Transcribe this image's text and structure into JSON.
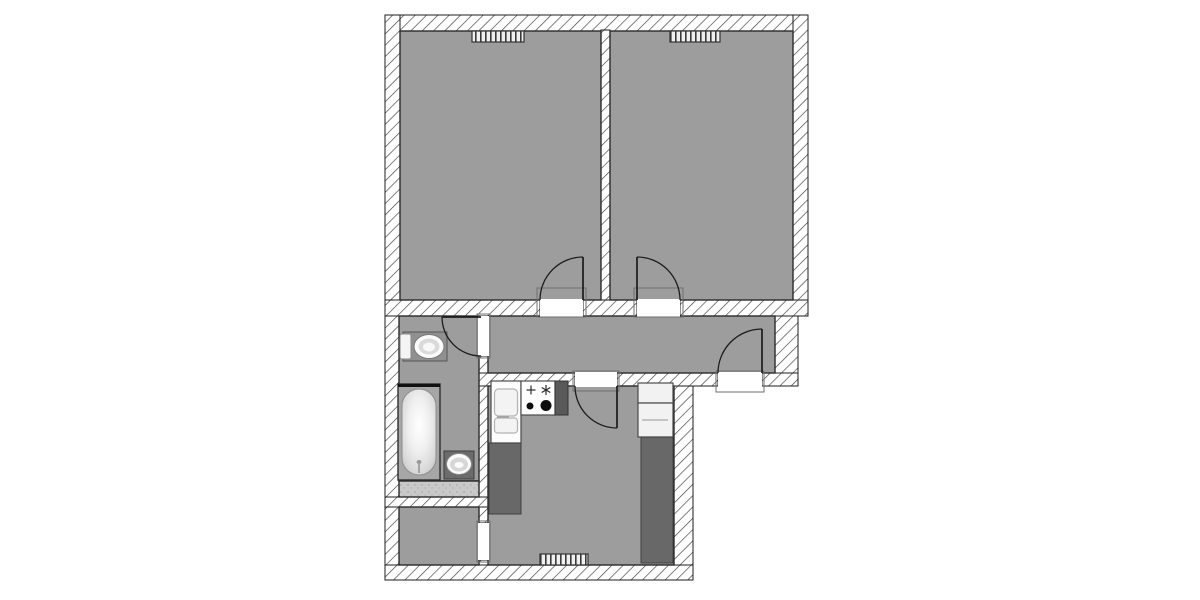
{
  "meta": {
    "type": "apartment-floor-plan",
    "canvas": {
      "width": 1200,
      "height": 600,
      "background": "#ffffff"
    }
  },
  "palette": {
    "floor": "#9d9d9d",
    "wall_outline": "#1d1d1d",
    "door_stroke": "#1c1c1c",
    "threshold_stroke": "#6f6f6f",
    "counter_dark": "#686868",
    "fixture_white": "#f8f8f8",
    "ledge_light": "#c9c9c9",
    "hatch_line": "#3c3c3c",
    "burner_black": "#0d0d0d"
  },
  "rooms": [
    {
      "name": "bedroom-left"
    },
    {
      "name": "bedroom-right"
    },
    {
      "name": "corridor"
    },
    {
      "name": "bathroom"
    },
    {
      "name": "storage"
    },
    {
      "name": "kitchen"
    }
  ],
  "plan": {
    "walls": [
      {
        "name": "wall-top",
        "rect": [
          385,
          15,
          423,
          16
        ]
      },
      {
        "name": "wall-left-upper",
        "rect": [
          385,
          15,
          15,
          301
        ]
      },
      {
        "name": "wall-right-upper",
        "rect": [
          793,
          15,
          15,
          301
        ]
      },
      {
        "name": "wall-bedroom-partition",
        "rect": [
          601,
          30,
          9,
          271
        ]
      },
      {
        "name": "wall-rooms-bottom-left",
        "rect": [
          385,
          300,
          155,
          16
        ]
      },
      {
        "name": "wall-rooms-bottom-mid",
        "rect": [
          583,
          300,
          54,
          16
        ]
      },
      {
        "name": "wall-rooms-bottom-right",
        "rect": [
          680,
          300,
          128,
          16
        ]
      },
      {
        "name": "wall-left-lower",
        "rect": [
          385,
          316,
          14,
          264
        ]
      },
      {
        "name": "wall-bath-kitchen",
        "rect": [
          479,
          356,
          10,
          167
        ]
      },
      {
        "name": "wall-bath-kitchen-lower",
        "rect": [
          479,
          560,
          10,
          20
        ]
      },
      {
        "name": "wall-bath-storage",
        "rect": [
          385,
          497,
          104,
          10
        ]
      },
      {
        "name": "wall-corridor-bottom-left",
        "rect": [
          479,
          373,
          96,
          13
        ]
      },
      {
        "name": "wall-corridor-bottom-mid",
        "rect": [
          617,
          373,
          101,
          13
        ]
      },
      {
        "name": "wall-corridor-bottom-right",
        "rect": [
          762,
          373,
          36,
          13
        ]
      },
      {
        "name": "wall-corridor-right",
        "rect": [
          775,
          316,
          23,
          57
        ]
      },
      {
        "name": "wall-kitchen-right",
        "rect": [
          674,
          386,
          19,
          194
        ]
      },
      {
        "name": "wall-bottom",
        "rect": [
          385,
          565,
          308,
          15
        ]
      }
    ],
    "floors": [
      {
        "name": "bedroom-left-floor",
        "rect": [
          400,
          31,
          201,
          269
        ],
        "fill": "$floor"
      },
      {
        "name": "bedroom-right-floor",
        "rect": [
          610,
          31,
          183,
          269
        ],
        "fill": "$floor"
      },
      {
        "name": "corridor-floor",
        "rect": [
          488,
          316,
          287,
          57
        ],
        "fill": "$floor"
      },
      {
        "name": "bathroom-floor",
        "rect": [
          399,
          316,
          80,
          165
        ],
        "fill": "$floor"
      },
      {
        "name": "bathroom-ledge",
        "rect": [
          399,
          481,
          80,
          16
        ],
        "fill": "url(#speckle)"
      },
      {
        "name": "storage-floor",
        "rect": [
          399,
          507,
          80,
          58
        ],
        "fill": "$floor"
      },
      {
        "name": "kitchen-floor",
        "rect": [
          488,
          386,
          186,
          179
        ],
        "fill": "$floor"
      }
    ],
    "door_openings": [
      {
        "name": "bedroom-left-door-opening",
        "rect": [
          540,
          299,
          43,
          18
        ]
      },
      {
        "name": "bedroom-right-door-opening",
        "rect": [
          637,
          299,
          43,
          18
        ]
      },
      {
        "name": "wc-door-opening",
        "rect": [
          478,
          316,
          11,
          40
        ]
      },
      {
        "name": "kitchen-door-opening",
        "rect": [
          575,
          372,
          42,
          15
        ]
      },
      {
        "name": "entry-door-opening",
        "rect": [
          718,
          372,
          44,
          15
        ]
      },
      {
        "name": "storage-opening",
        "rect": [
          478,
          523,
          11,
          37
        ]
      }
    ],
    "thresholds": [
      {
        "name": "bedroom-left-threshold",
        "rect": [
          537,
          288,
          49,
          29
        ]
      },
      {
        "name": "bedroom-right-threshold",
        "rect": [
          634,
          288,
          49,
          29
        ]
      },
      {
        "name": "wc-threshold",
        "rect": [
          477,
          314,
          13,
          44
        ]
      },
      {
        "name": "kitchen-threshold",
        "rect": [
          573,
          371,
          46,
          20
        ]
      },
      {
        "name": "entry-threshold",
        "rect": [
          716,
          371,
          48,
          21
        ]
      },
      {
        "name": "storage-opening-threshold",
        "rect": [
          477,
          521,
          13,
          41
        ]
      }
    ],
    "radiators": [
      {
        "name": "bedroom-left-radiator",
        "rect": [
          472,
          31,
          52,
          11
        ]
      },
      {
        "name": "bedroom-right-radiator",
        "rect": [
          670,
          31,
          50,
          11
        ]
      },
      {
        "name": "kitchen-radiator",
        "rect": [
          540,
          554,
          48,
          11
        ]
      }
    ],
    "doors": [
      {
        "name": "bedroom-left-door",
        "leaf": "M583,300 L583,257",
        "arc": "M583,257 A43,43 0 0 0 540,300"
      },
      {
        "name": "bedroom-right-door",
        "leaf": "M637,300 L637,257",
        "arc": "M637,257 A43,43 0 0 1 680,300"
      },
      {
        "name": "wc-door",
        "leaf": "M481,317 L442,317",
        "arc": "M442,317 A39,39 0 0 0 481,356"
      },
      {
        "name": "kitchen-door",
        "leaf": "M617,386 L617,428",
        "arc": "M575,386 A42,42 0 0 0 617,428"
      },
      {
        "name": "entry-door",
        "leaf": "M762,373 L762,329",
        "arc": "M762,329 A44,44 0 0 0 718,373"
      }
    ],
    "fixtures": [
      {
        "name": "toilet",
        "shapes": [
          {
            "t": "rect",
            "r": [
              403,
              332,
              44,
              29
            ],
            "f": "#909090",
            "s": "#555555",
            "sw": 1
          },
          {
            "t": "rect",
            "r": [
              400,
              334,
              11,
              25
            ],
            "rx": 2,
            "f": "#f4f4f4",
            "s": "#888888",
            "sw": 1
          },
          {
            "t": "ellipse",
            "c": [
              429,
              346.5,
              15,
              12
            ],
            "f": "#fbfbfb",
            "s": "#777777",
            "sw": 1
          },
          {
            "t": "ellipse",
            "c": [
              429,
              346.5,
              10.5,
              8
            ],
            "f": "#dadada"
          },
          {
            "t": "ellipse",
            "c": [
              429,
              347,
              6,
              4.5
            ],
            "f": "#f8f8f8"
          }
        ]
      },
      {
        "name": "bathtub",
        "shapes": [
          {
            "t": "rect",
            "r": [
              398,
              384,
              42,
              96
            ],
            "f": "#a6a6a6",
            "s": "#2e2e2e",
            "sw": 1.4
          },
          {
            "t": "line",
            "p": [
              398,
              385.5,
              440,
              385.5
            ],
            "s": "#111111",
            "sw": 3
          },
          {
            "t": "rect",
            "r": [
              402,
              389,
              34,
              86
            ],
            "rx": 17,
            "f": "url(#tub-gradient)",
            "s": "#8e8e8e",
            "sw": 1
          },
          {
            "t": "ellipse",
            "c": [
              419,
              462,
              2.5,
              2
            ],
            "f": "#9a9a9a"
          },
          {
            "t": "line",
            "p": [
              419,
              464,
              419,
              473
            ],
            "s": "#8a8a8a",
            "sw": 1.4
          }
        ]
      },
      {
        "name": "bathroom-sink",
        "shapes": [
          {
            "t": "rect",
            "r": [
              444,
              451,
              30,
              28
            ],
            "f": "#6b6b6b",
            "s": "#3d3d3d",
            "sw": 1
          },
          {
            "t": "ellipse",
            "c": [
              459,
              464,
              12.5,
              10.5
            ],
            "f": "#fafafa",
            "s": "#8a8a8a",
            "sw": 1
          },
          {
            "t": "ellipse",
            "c": [
              459,
              464.5,
              9,
              7
            ],
            "f": "#d7d7d7"
          },
          {
            "t": "ellipse",
            "c": [
              459,
              465,
              4.5,
              3
            ],
            "f": "#fbfbfb"
          },
          {
            "t": "line",
            "p": [
              455,
              474,
              455,
              478
            ],
            "s": "#666666",
            "sw": 1.2
          },
          {
            "t": "line",
            "p": [
              462,
              474,
              462,
              478
            ],
            "s": "#666666",
            "sw": 1.2
          }
        ]
      },
      {
        "name": "kitchen-sink-unit",
        "shapes": [
          {
            "t": "rect",
            "r": [
              491,
              381,
              30,
              62
            ],
            "f": "#fcfcfc",
            "s": "#4a4a4a",
            "sw": 1.2
          },
          {
            "t": "rect",
            "r": [
              494.5,
              389,
              23,
              27
            ],
            "rx": 4,
            "f": "#f3f3f3",
            "s": "#b3b3b3",
            "sw": 1.2
          },
          {
            "t": "rect",
            "r": [
              494.5,
              418,
              23,
              15
            ],
            "rx": 3,
            "f": "#f3f3f3",
            "s": "#b3b3b3",
            "sw": 1.2
          },
          {
            "t": "line",
            "p": [
              497,
              417,
              509,
              417
            ],
            "s": "#9a9a9a",
            "sw": 1.2
          }
        ]
      },
      {
        "name": "stove",
        "shapes": [
          {
            "t": "rect",
            "r": [
              521,
              381,
              34,
              34
            ],
            "f": "#fdfdfd",
            "s": "#4a4a4a",
            "sw": 1.2
          },
          {
            "t": "line",
            "p": [
              526.5,
              390,
              535.5,
              390
            ],
            "s": "#2c2c2c",
            "sw": 1.2
          },
          {
            "t": "line",
            "p": [
              531,
              385.5,
              531,
              394.5
            ],
            "s": "#2c2c2c",
            "sw": 1.2
          },
          {
            "t": "line",
            "p": [
              546,
              385,
              546,
              395
            ],
            "s": "#2c2c2c",
            "sw": 1.2
          },
          {
            "t": "line",
            "p": [
              541.7,
              387.5,
              550.3,
              392.5
            ],
            "s": "#2c2c2c",
            "sw": 1.2
          },
          {
            "t": "line",
            "p": [
              541.7,
              392.5,
              550.3,
              387.5
            ],
            "s": "#2c2c2c",
            "sw": 1.2
          },
          {
            "t": "circle",
            "c": [
              530,
              406,
              3.5
            ],
            "f": "#0d0d0d"
          },
          {
            "t": "circle",
            "c": [
              546,
              405.5,
              5.5
            ],
            "f": "#0d0d0d"
          }
        ]
      },
      {
        "name": "stove-side-cabinet",
        "shapes": [
          {
            "t": "rect",
            "r": [
              555,
              381,
              13,
              34
            ],
            "f": "#595959",
            "s": "#333333",
            "sw": 1
          }
        ]
      },
      {
        "name": "kitchen-counter-left",
        "shapes": [
          {
            "t": "rect",
            "r": [
              489,
              443,
              32,
              71
            ],
            "f": "$counter_dark",
            "s": "#3f3f3f",
            "sw": 1
          }
        ]
      },
      {
        "name": "kitchen-wall-cabinet-upper",
        "shapes": [
          {
            "t": "rect",
            "r": [
              638,
              383,
              35,
              20
            ],
            "f": "#f2f2f2",
            "s": "#4a4a4a",
            "sw": 1.2
          }
        ]
      },
      {
        "name": "kitchen-wall-cabinet-lower",
        "shapes": [
          {
            "t": "rect",
            "r": [
              638,
              403,
              35,
              34
            ],
            "f": "#f2f2f2",
            "s": "#4a4a4a",
            "sw": 1.2
          },
          {
            "t": "line",
            "p": [
              642,
              420,
              668,
              420
            ],
            "s": "#aaaaaa",
            "sw": 1.2
          }
        ]
      },
      {
        "name": "kitchen-counter-right",
        "shapes": [
          {
            "t": "rect",
            "r": [
              641,
              437,
              32,
              126
            ],
            "f": "$counter_dark",
            "s": "#3f3f3f",
            "sw": 1
          }
        ]
      }
    ]
  }
}
